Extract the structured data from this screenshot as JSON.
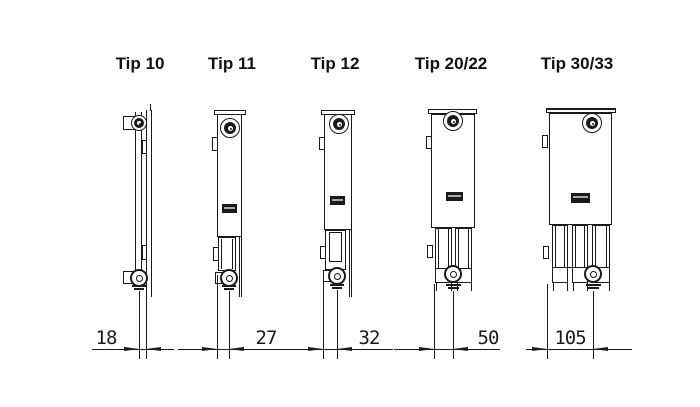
{
  "page": {
    "background": "#ffffff",
    "line_color": "#1a1a1a",
    "description": "Radiator type cross-section depth diagram"
  },
  "radiators": [
    {
      "id": "tip-10",
      "title": "Tip 10",
      "depth": "18"
    },
    {
      "id": "tip-11",
      "title": "Tip 11",
      "depth": "27"
    },
    {
      "id": "tip-12",
      "title": "Tip 12",
      "depth": "32"
    },
    {
      "id": "tip-20-22",
      "title": "Tip 20/22",
      "depth": "50"
    },
    {
      "id": "tip-30-33",
      "title": "Tip 30/33",
      "depth": "105"
    }
  ]
}
